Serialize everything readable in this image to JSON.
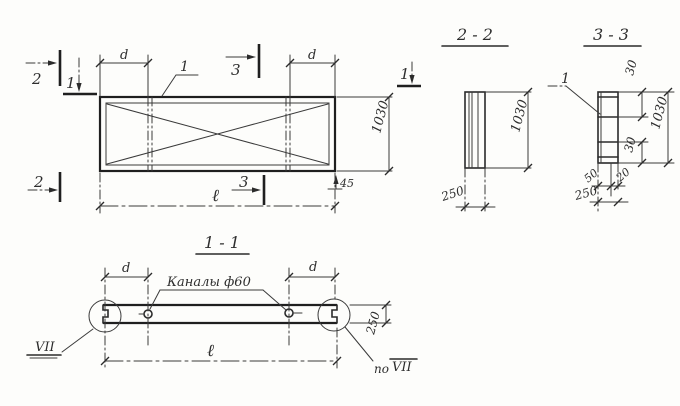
{
  "plan": {
    "mark_2_top": "2",
    "mark_1_left": "1",
    "mark_3_top": "3",
    "mark_2_bottom": "2",
    "mark_3_bottom": "3",
    "mark_1_right": "1",
    "item_leader": "1",
    "dim_d_left": "d",
    "dim_d_right": "d",
    "dim_width": "1030",
    "dim_corner": "45",
    "dim_length": "ℓ"
  },
  "sec22": {
    "title": "2 - 2",
    "dim_height": "1030",
    "dim_thickness": "250"
  },
  "sec33": {
    "title": "3 - 3",
    "item_leader": "1",
    "dim_top": "30",
    "dim_height": "1030",
    "dim_bottom": "30",
    "dim_50": "50",
    "dim_20": "20",
    "dim_thickness": "250"
  },
  "sec11": {
    "title": "1 - 1",
    "channels": "Каналы ф60",
    "dim_d_left": "d",
    "dim_d_right": "d",
    "dim_thickness": "250",
    "dim_length": "ℓ",
    "detail_left": "VII",
    "detail_right_prefix": "по",
    "detail_right": "VII"
  },
  "colors": {
    "paper": "#fdfdfb",
    "ink": "#2b2b2b"
  }
}
